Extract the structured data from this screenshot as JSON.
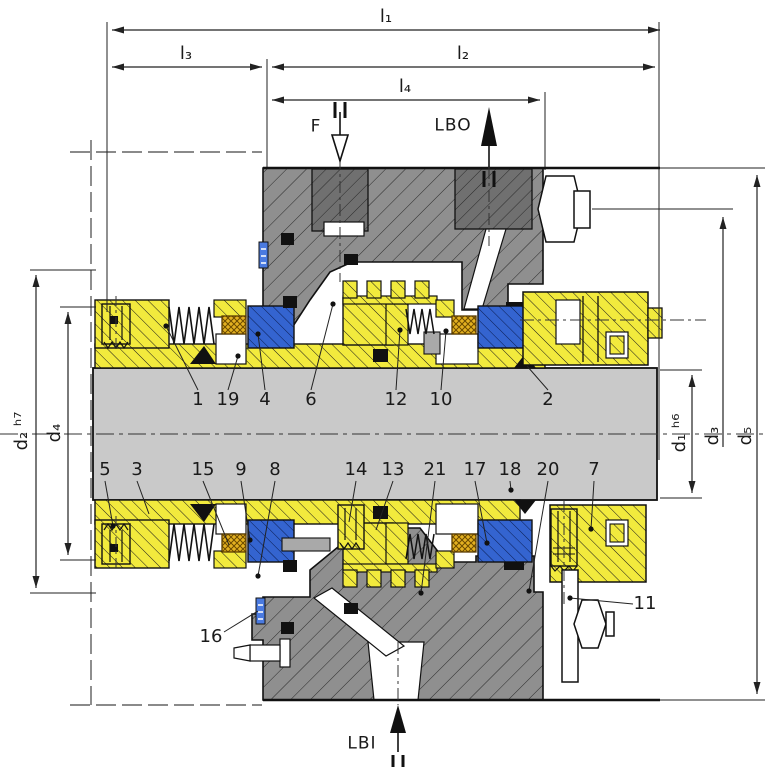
{
  "drawing": {
    "length_dimension_labels": [
      {
        "text": "l₁",
        "x": 386,
        "y": 17
      },
      {
        "text": "l₃",
        "x": 186,
        "y": 54
      },
      {
        "text": "l₂",
        "x": 463,
        "y": 54
      },
      {
        "text": "l₄",
        "x": 405,
        "y": 87
      }
    ],
    "diameter_dimension_labels": [
      {
        "text": "d₂ ʰ⁷",
        "x": 22,
        "y": 431,
        "rot": true
      },
      {
        "text": "d₄",
        "x": 55,
        "y": 433,
        "rot": true
      },
      {
        "text": "d₁ ʰ⁶",
        "x": 680,
        "y": 433,
        "rot": true
      },
      {
        "text": "d₃",
        "x": 713,
        "y": 436,
        "rot": true
      },
      {
        "text": "d₅",
        "x": 746,
        "y": 436,
        "rot": true
      }
    ],
    "port_labels": [
      {
        "text": "F",
        "x": 316,
        "y": 127
      },
      {
        "text": "LBO",
        "x": 453,
        "y": 126
      },
      {
        "text": "LBI",
        "x": 362,
        "y": 744
      }
    ],
    "part_callouts": [
      {
        "text": "1",
        "x": 198,
        "y": 400,
        "x1": 198,
        "y1": 390,
        "x2": 166,
        "y2": 326,
        "dot": true
      },
      {
        "text": "19",
        "x": 228,
        "y": 400,
        "x1": 228,
        "y1": 390,
        "x2": 238,
        "y2": 356,
        "dot": true
      },
      {
        "text": "4",
        "x": 265,
        "y": 400,
        "x1": 265,
        "y1": 390,
        "x2": 258,
        "y2": 334,
        "dot": true
      },
      {
        "text": "6",
        "x": 311,
        "y": 400,
        "x1": 311,
        "y1": 390,
        "x2": 333,
        "y2": 304,
        "dot": true
      },
      {
        "text": "12",
        "x": 396,
        "y": 400,
        "x1": 396,
        "y1": 390,
        "x2": 400,
        "y2": 330,
        "dot": true
      },
      {
        "text": "10",
        "x": 441,
        "y": 400,
        "x1": 441,
        "y1": 390,
        "x2": 446,
        "y2": 331,
        "dot": true
      },
      {
        "text": "2",
        "x": 548,
        "y": 400,
        "x1": 548,
        "y1": 390,
        "x2": 527,
        "y2": 366,
        "dot": false
      },
      {
        "text": "5",
        "x": 105,
        "y": 470,
        "x1": 105,
        "y1": 481,
        "x2": 113,
        "y2": 526,
        "dot": true
      },
      {
        "text": "3",
        "x": 137,
        "y": 470,
        "x1": 137,
        "y1": 481,
        "x2": 149,
        "y2": 514,
        "dot": false
      },
      {
        "text": "15",
        "x": 203,
        "y": 470,
        "x1": 203,
        "y1": 481,
        "x2": 229,
        "y2": 545,
        "dot": false
      },
      {
        "text": "9",
        "x": 241,
        "y": 470,
        "x1": 241,
        "y1": 481,
        "x2": 250,
        "y2": 540,
        "dot": true
      },
      {
        "text": "8",
        "x": 275,
        "y": 470,
        "x1": 275,
        "y1": 481,
        "x2": 258,
        "y2": 576,
        "dot": true
      },
      {
        "text": "14",
        "x": 356,
        "y": 470,
        "x1": 356,
        "y1": 481,
        "x2": 349,
        "y2": 522,
        "dot": false
      },
      {
        "text": "13",
        "x": 393,
        "y": 470,
        "x1": 393,
        "y1": 481,
        "x2": 376,
        "y2": 530,
        "dot": false
      },
      {
        "text": "21",
        "x": 435,
        "y": 470,
        "x1": 435,
        "y1": 481,
        "x2": 421,
        "y2": 593,
        "dot": true
      },
      {
        "text": "17",
        "x": 475,
        "y": 470,
        "x1": 475,
        "y1": 481,
        "x2": 487,
        "y2": 543,
        "dot": true
      },
      {
        "text": "18",
        "x": 510,
        "y": 470,
        "x1": 510,
        "y1": 481,
        "x2": 511,
        "y2": 490,
        "dot": true
      },
      {
        "text": "20",
        "x": 548,
        "y": 470,
        "x1": 548,
        "y1": 481,
        "x2": 529,
        "y2": 591,
        "dot": true
      },
      {
        "text": "7",
        "x": 594,
        "y": 470,
        "x1": 594,
        "y1": 481,
        "x2": 591,
        "y2": 529,
        "dot": true
      },
      {
        "text": "16",
        "x": 211,
        "y": 637,
        "x1": 224,
        "y1": 632,
        "x2": 258,
        "y2": 611,
        "dot": false
      },
      {
        "text": "11",
        "x": 645,
        "y": 604,
        "x1": 633,
        "y1": 604,
        "x2": 570,
        "y2": 598,
        "dot": true
      }
    ],
    "colors": {
      "component_yellow": "#f2ea3d",
      "seal_ring_blue": "#3464d0",
      "oring_gold": "#e3b020",
      "shaft_gray": "#c9c9c9",
      "housing_gray": "#8f8f8f",
      "bore_gray": "#707070",
      "line": "#111111"
    }
  }
}
